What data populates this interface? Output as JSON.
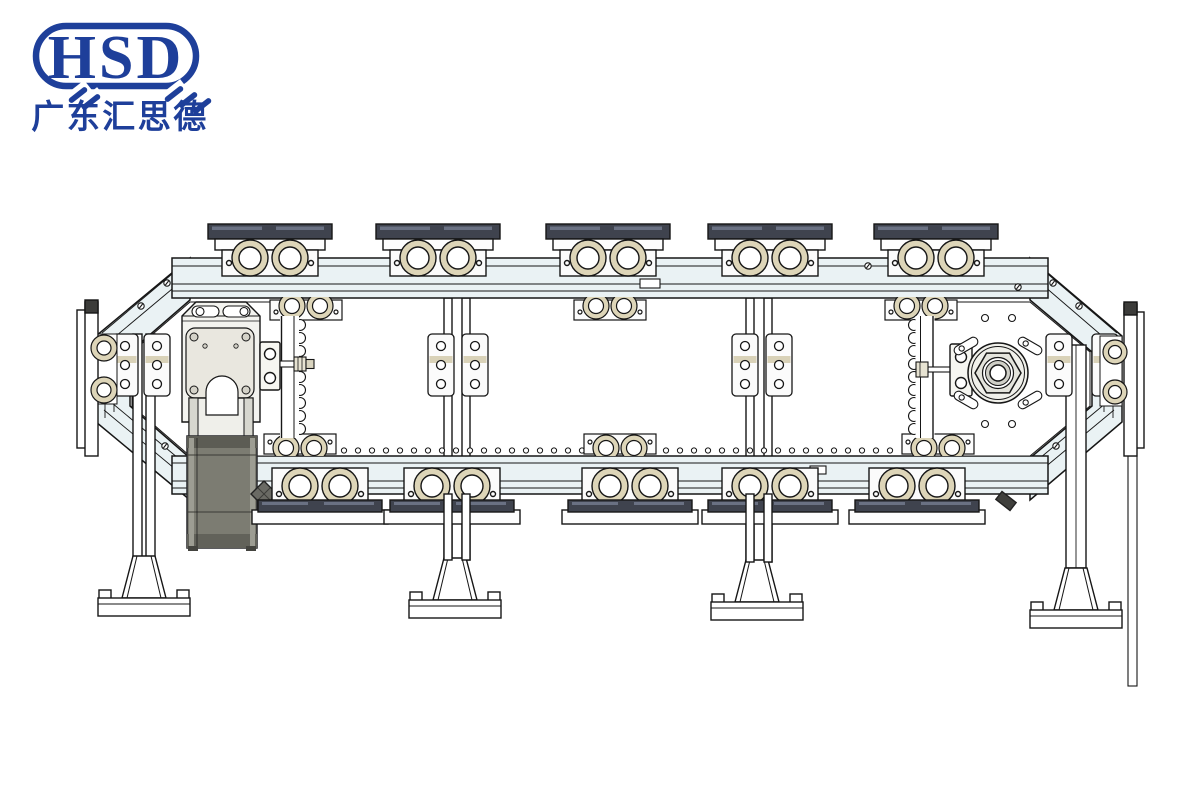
{
  "page": {
    "background": "#ffffff"
  },
  "logo": {
    "text": "HSD",
    "subtext": "广东汇思德",
    "color": "#1e3f9a"
  },
  "colors": {
    "brand_blue": "#1e3f9a",
    "line": "#161616",
    "frame_fill": "#eaf2f4",
    "plate_white": "#fdfdfd",
    "roller_tan": "#ddd5b8",
    "carrier_dark": "#3f434e",
    "motor_gray": "#7c7c72",
    "gearbox_face": "#e9e7df",
    "cap_dark": "#3c3c3a"
  },
  "drawing": {
    "carriers_top": [
      270,
      438,
      608,
      770,
      936
    ],
    "carriers_bottom": [
      320,
      452,
      630,
      770,
      917
    ],
    "carriers_inner_top": [
      306,
      610,
      921
    ],
    "carriers_inner_bottom": [
      300,
      620,
      938
    ],
    "leg_feet": [
      {
        "x": 144,
        "dy": 0
      },
      {
        "x": 455,
        "dy": 2
      },
      {
        "x": 757,
        "dy": 4
      },
      {
        "x": 1076,
        "dy": 12
      }
    ],
    "bracket_plates": [
      [
        112,
        334
      ],
      [
        144,
        334
      ],
      [
        428,
        334
      ],
      [
        462,
        334
      ],
      [
        732,
        334
      ],
      [
        766,
        334
      ],
      [
        1046,
        334
      ],
      [
        1092,
        334
      ]
    ],
    "bolts": [
      [
        225,
        268
      ],
      [
        438,
        266
      ],
      [
        652,
        266
      ],
      [
        868,
        266
      ],
      [
        1018,
        287
      ],
      [
        167,
        283
      ],
      [
        141,
        306
      ],
      [
        165,
        446
      ],
      [
        1053,
        283
      ],
      [
        1079,
        306
      ],
      [
        1056,
        446
      ]
    ],
    "tension_slots": [
      [
        966,
        346,
        -30
      ],
      [
        1030,
        346,
        30
      ],
      [
        966,
        400,
        30
      ],
      [
        1030,
        400,
        -30
      ]
    ],
    "chain": {
      "x_start": 302,
      "x_end": 896,
      "step": 14,
      "y": 450.5,
      "r": 2.6
    }
  }
}
